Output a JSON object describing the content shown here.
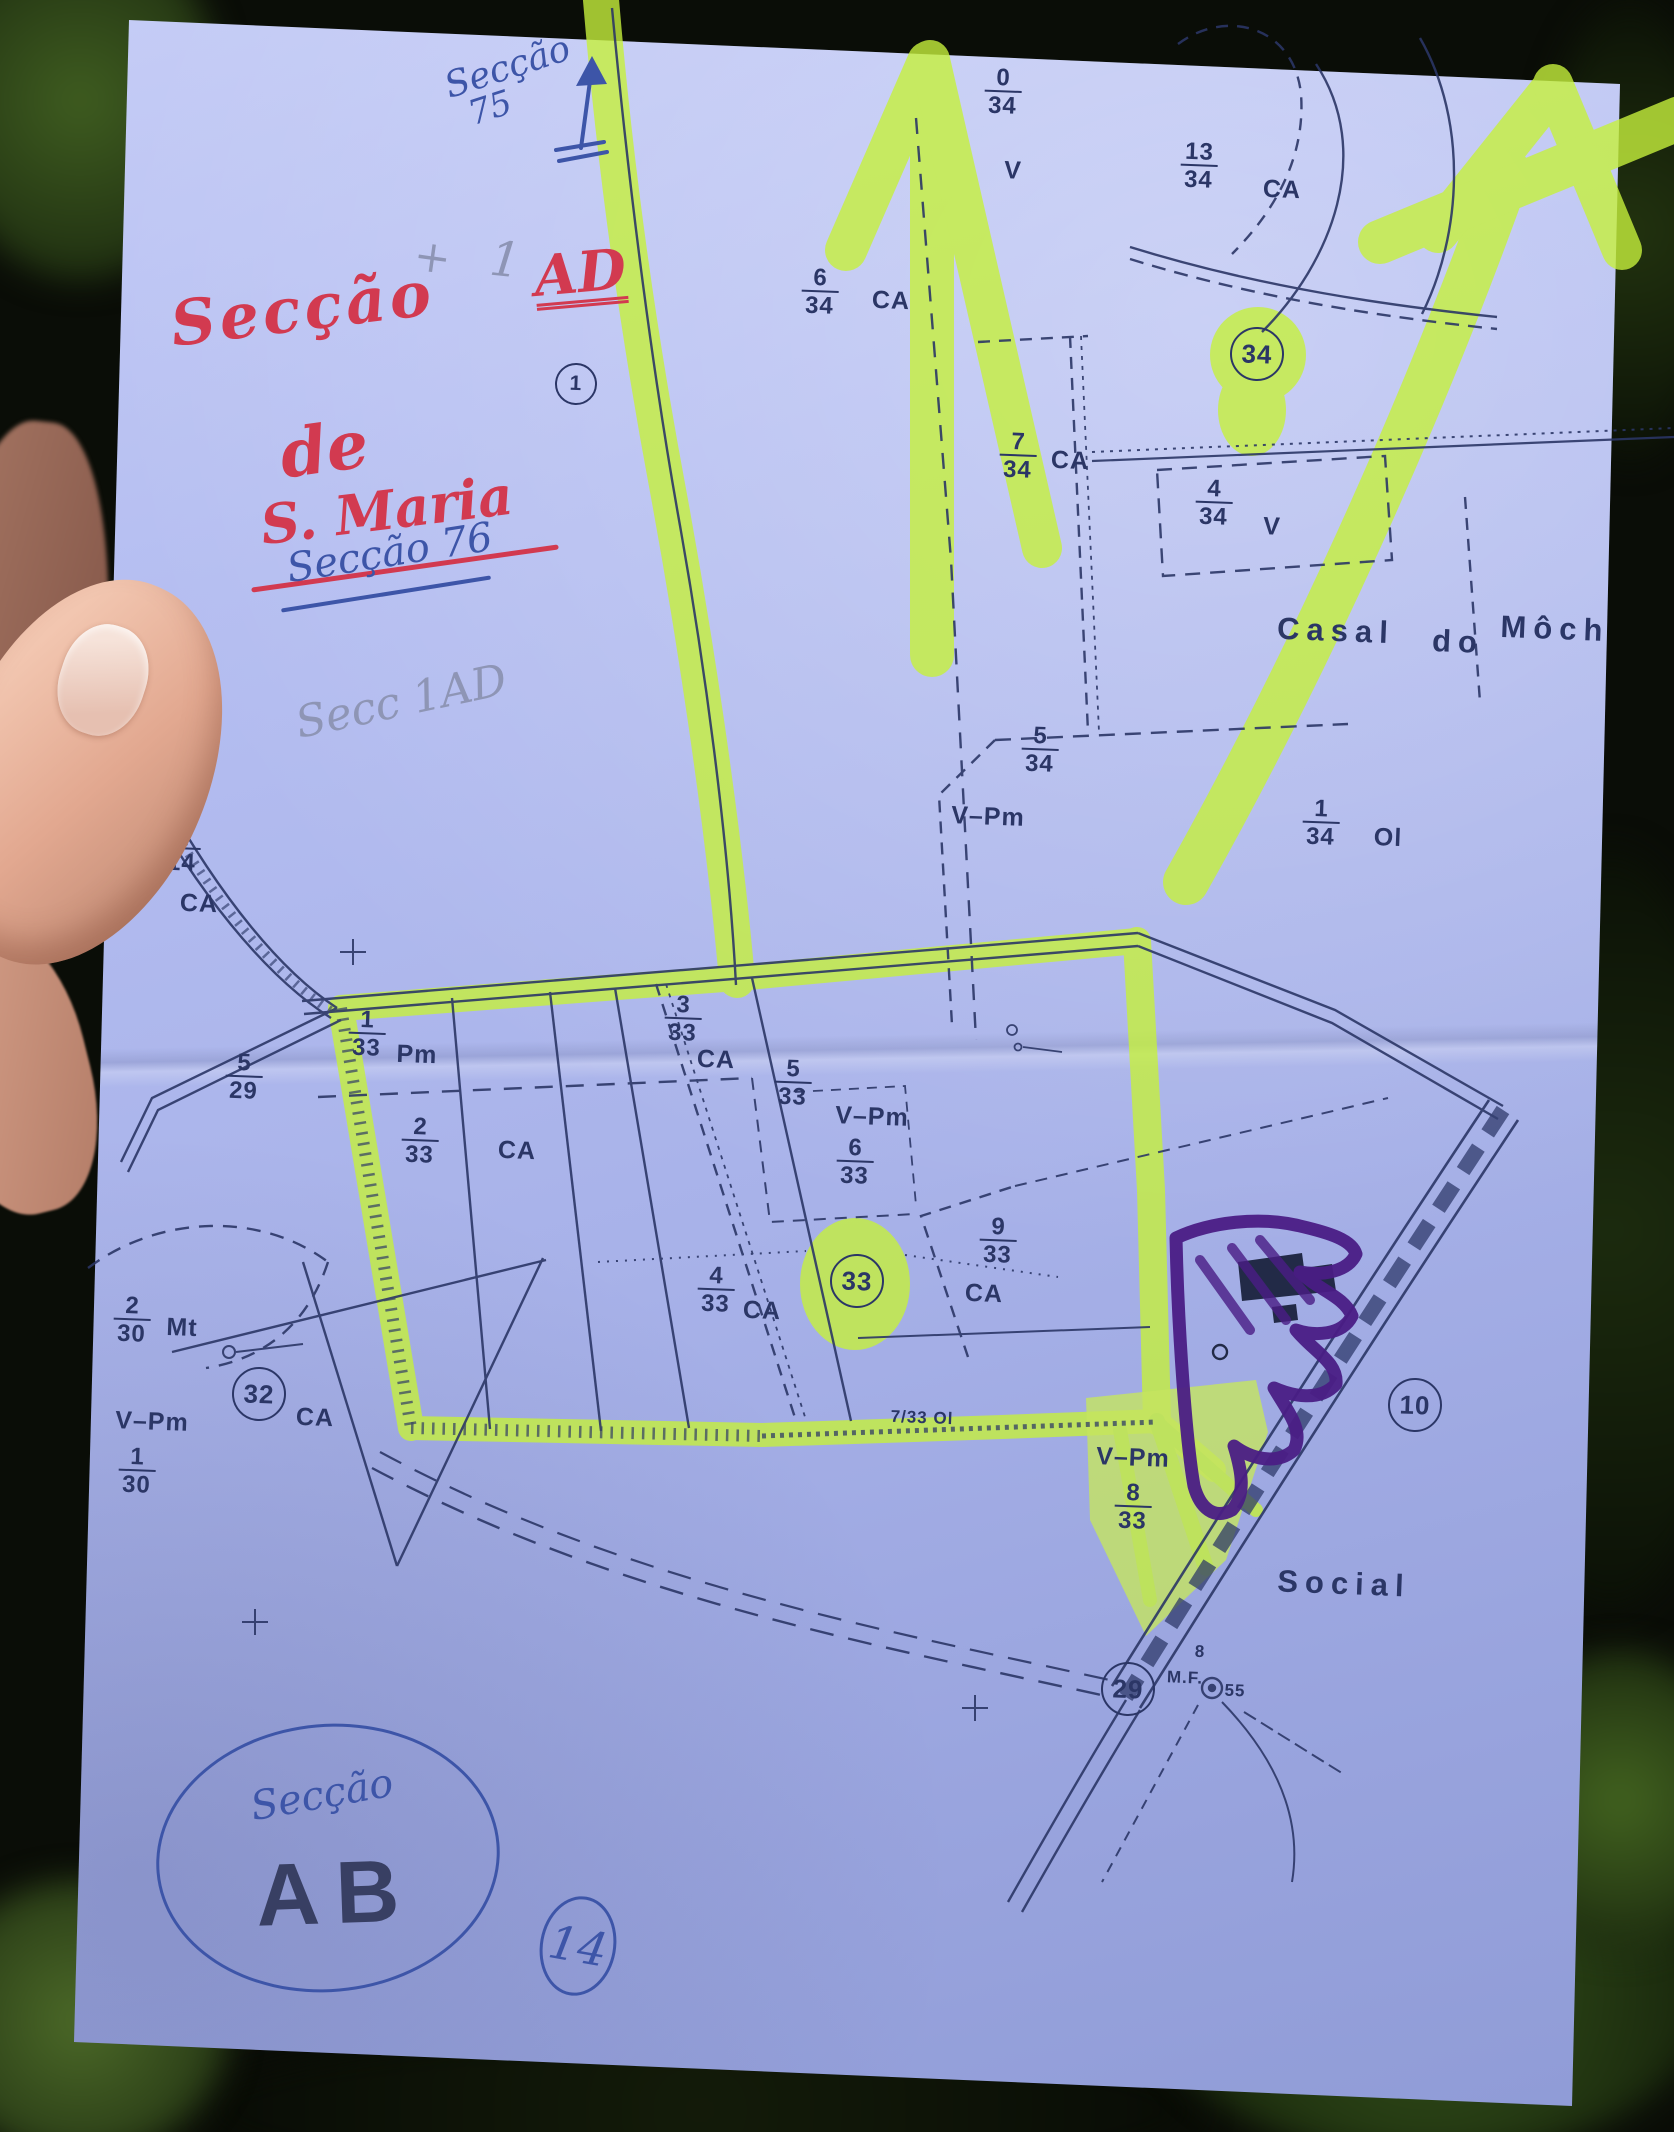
{
  "colors": {
    "highlighter": "#c6f03c",
    "ink": "#2b3666",
    "red_pen": "#d23a50",
    "blue_pen": "#3d55a8",
    "purple_marker": "#4a1d85",
    "paper": "#aab4ea",
    "pencil": "#8e95b5"
  },
  "handwriting": {
    "top_note_line1": "Secção",
    "top_note_line2": "75",
    "pencil_cross": "+",
    "pencil_one": "1",
    "title_word": "Secção",
    "title_code": "AD",
    "title_de": "de",
    "title_name": "S. Maria",
    "blue_note": "Secção 76",
    "pencil_note": "Secc 1AD",
    "bottom_secao": "Secção",
    "bottom_code": "AB",
    "bottom_circled": "14"
  },
  "map": {
    "labels": [
      {
        "t": "frac",
        "num": "0",
        "den": "34",
        "x": 59.9,
        "y": 4.3
      },
      {
        "t": "txt",
        "s": "V",
        "x": 60.5,
        "y": 8.0
      },
      {
        "t": "frac",
        "num": "13",
        "den": "34",
        "x": 71.6,
        "y": 7.8
      },
      {
        "t": "txt",
        "s": "CA",
        "x": 76.6,
        "y": 8.9
      },
      {
        "t": "frac",
        "num": "6",
        "den": "34",
        "x": 49.0,
        "y": 13.7
      },
      {
        "t": "txt",
        "s": "CA",
        "x": 53.2,
        "y": 14.1
      },
      {
        "t": "circ",
        "s": "34",
        "x": 75.1,
        "y": 16.6
      },
      {
        "t": "frac",
        "num": "7",
        "den": "34",
        "x": 60.8,
        "y": 21.4
      },
      {
        "t": "txt",
        "s": "CA",
        "x": 63.9,
        "y": 21.6
      },
      {
        "t": "frac",
        "num": "4",
        "den": "34",
        "x": 72.5,
        "y": 23.6
      },
      {
        "t": "txt",
        "s": "V",
        "x": 76.0,
        "y": 24.7
      },
      {
        "t": "place",
        "s": "Casal",
        "x": 79.8,
        "y": 29.6
      },
      {
        "t": "place",
        "s": "do",
        "x": 87.1,
        "y": 30.1
      },
      {
        "t": "place",
        "s": "Môch",
        "x": 92.9,
        "y": 29.5
      },
      {
        "t": "frac",
        "num": "5",
        "den": "34",
        "x": 62.1,
        "y": 35.2
      },
      {
        "t": "txt",
        "s": "V–Pm",
        "x": 59.0,
        "y": 38.3
      },
      {
        "t": "frac",
        "num": "1",
        "den": "34",
        "x": 78.9,
        "y": 38.6
      },
      {
        "t": "txt",
        "s": "Ol",
        "x": 82.9,
        "y": 39.3
      },
      {
        "t": "frac",
        "num": "5",
        "den": "14",
        "x": 10.9,
        "y": 39.8
      },
      {
        "t": "txt",
        "s": "CA",
        "x": 11.9,
        "y": 42.4
      },
      {
        "t": "frac",
        "num": "5",
        "den": "29",
        "x": 14.6,
        "y": 50.5
      },
      {
        "t": "frac",
        "num": "1",
        "den": "33",
        "x": 21.9,
        "y": 48.5
      },
      {
        "t": "txt",
        "s": "Pm",
        "x": 24.9,
        "y": 49.5
      },
      {
        "t": "frac",
        "num": "3",
        "den": "33",
        "x": 40.8,
        "y": 47.8
      },
      {
        "t": "txt",
        "s": "CA",
        "x": 42.8,
        "y": 49.7
      },
      {
        "t": "frac",
        "num": "5",
        "den": "33",
        "x": 47.4,
        "y": 50.8
      },
      {
        "t": "txt",
        "s": "V–Pm",
        "x": 52.1,
        "y": 52.4
      },
      {
        "t": "frac",
        "num": "6",
        "den": "33",
        "x": 51.1,
        "y": 54.5
      },
      {
        "t": "frac",
        "num": "2",
        "den": "33",
        "x": 25.1,
        "y": 53.5
      },
      {
        "t": "txt",
        "s": "CA",
        "x": 30.9,
        "y": 54.0
      },
      {
        "t": "frac",
        "num": "4",
        "den": "33",
        "x": 42.8,
        "y": 60.5
      },
      {
        "t": "txt",
        "s": "CA",
        "x": 45.5,
        "y": 61.5
      },
      {
        "t": "circ",
        "s": "33",
        "x": 51.2,
        "y": 60.1
      },
      {
        "t": "frac",
        "num": "9",
        "den": "33",
        "x": 59.6,
        "y": 58.2
      },
      {
        "t": "txt",
        "s": "CA",
        "x": 58.8,
        "y": 60.7
      },
      {
        "t": "frac",
        "num": "2",
        "den": "30",
        "x": 7.9,
        "y": 61.9
      },
      {
        "t": "txt",
        "s": "Mt",
        "x": 10.9,
        "y": 62.3
      },
      {
        "t": "circ",
        "s": "32",
        "x": 15.5,
        "y": 65.4
      },
      {
        "t": "txt",
        "s": "CA",
        "x": 18.8,
        "y": 66.5
      },
      {
        "t": "txt",
        "s": "V–Pm",
        "x": 9.1,
        "y": 66.7
      },
      {
        "t": "frac",
        "num": "1",
        "den": "30",
        "x": 8.2,
        "y": 69.0
      },
      {
        "t": "sm",
        "s": "7/33 Ol",
        "x": 55.1,
        "y": 66.5
      },
      {
        "t": "txt",
        "s": "V–Pm",
        "x": 67.7,
        "y": 68.4
      },
      {
        "t": "frac",
        "num": "8",
        "den": "33",
        "x": 67.7,
        "y": 70.7
      },
      {
        "t": "circ",
        "s": "10",
        "x": 84.5,
        "y": 65.9
      },
      {
        "t": "place",
        "s": "Social",
        "x": 80.3,
        "y": 74.3
      },
      {
        "t": "circ",
        "s": "29",
        "x": 67.4,
        "y": 79.2
      },
      {
        "t": "sm",
        "s": "M.F.",
        "x": 70.8,
        "y": 78.7
      },
      {
        "t": "sm",
        "s": "55",
        "x": 73.8,
        "y": 79.3
      },
      {
        "t": "circ",
        "s": "1",
        "x": 34.4,
        "y": 18.0,
        "small": true
      },
      {
        "t": "sm",
        "s": "8",
        "x": 71.7,
        "y": 77.5
      }
    ]
  }
}
